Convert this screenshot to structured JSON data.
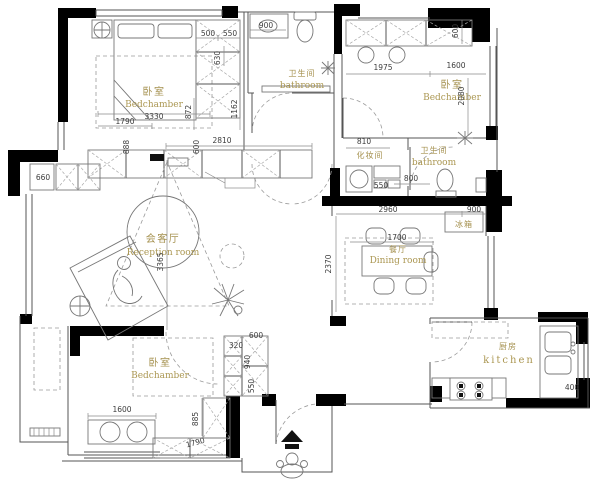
{
  "plan": {
    "rooms": {
      "bedroom1": {
        "zh": "卧室",
        "en": "Bedchamber"
      },
      "bathroom1": {
        "zh": "卫生间",
        "en": "bathroom"
      },
      "bedroom2": {
        "zh": "卧室",
        "en": "Bedchamber"
      },
      "dressing": {
        "zh": "化妆间"
      },
      "bathroom2": {
        "zh": "卫生间",
        "en": "bathroom"
      },
      "reception": {
        "zh": "会客厅",
        "en": "Reception room"
      },
      "dining": {
        "zh": "餐厅",
        "en": "Dining room"
      },
      "bedroom3": {
        "zh": "卧室",
        "en": "Bedchamber"
      },
      "kitchen": {
        "zh": "厨房",
        "en": "kitchen"
      },
      "fridge": {
        "zh": "冰箱"
      }
    },
    "dims": {
      "d500": "500",
      "d550a": "550",
      "d900a": "900",
      "d630": "630",
      "d600a": "600",
      "d888": "888",
      "d2810": "2810",
      "d3330": "3330",
      "d1790a": "1790",
      "d872": "872",
      "d1162": "1162",
      "d1975": "1975",
      "d1600a": "1600",
      "d2080": "2080",
      "d600b": "600",
      "d810": "810",
      "d550b": "550",
      "d800": "800",
      "d2960": "2960",
      "d900b": "900",
      "d1700": "1700",
      "d2370": "2370",
      "d3365": "3365",
      "d660": "660",
      "d320": "320",
      "d600c": "600",
      "d940": "940",
      "d550c": "550",
      "d1600b": "1600",
      "d885": "885",
      "d1790b": "1790",
      "d400": "400"
    },
    "colors": {
      "label_gold": "#a5914f",
      "wall_black": "#000000",
      "line_gray": "#555555"
    }
  }
}
